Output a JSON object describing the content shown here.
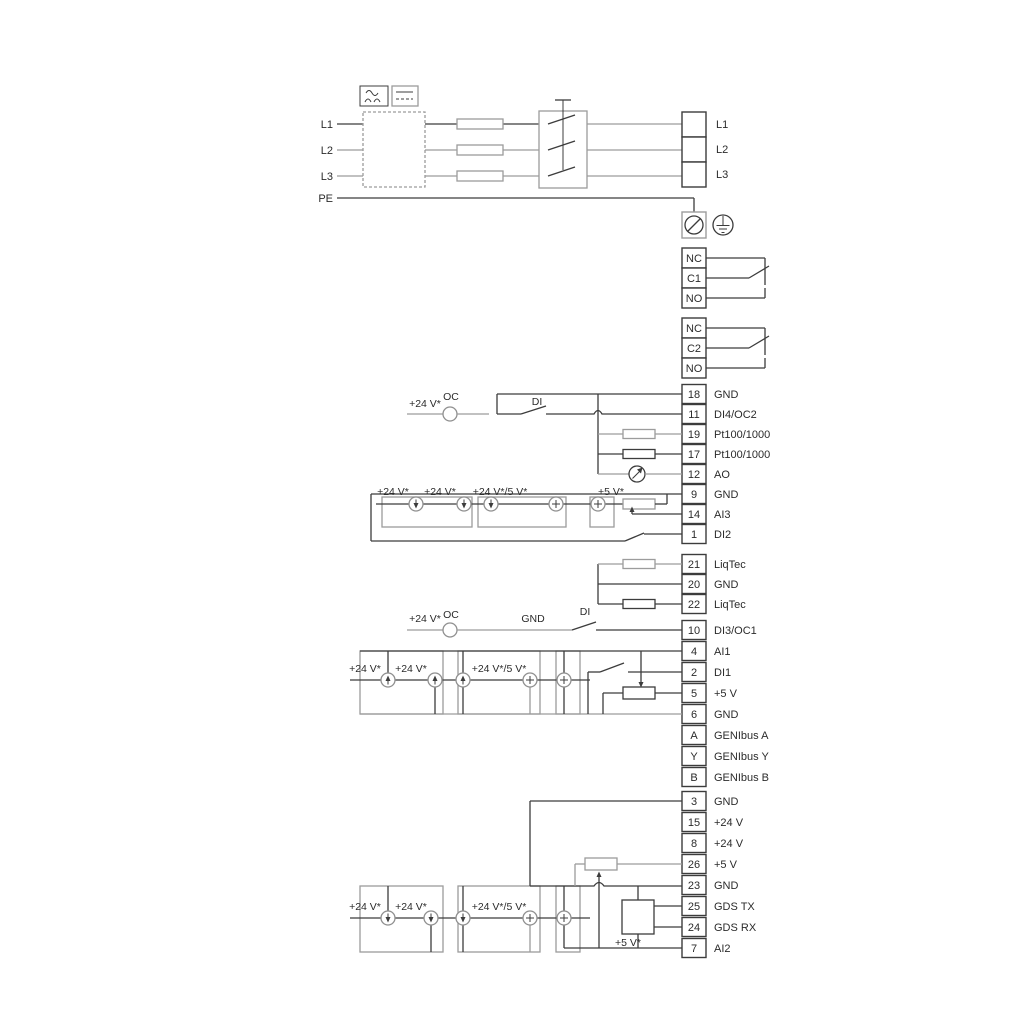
{
  "colors": {
    "dark": "#3c3c3c",
    "gray": "#9c9c9c",
    "background": "#ffffff"
  },
  "labels": {
    "v24": "+24 V*",
    "v24or5": "+24 V*/5 V*",
    "v5": "+5 V*",
    "oc": "OC",
    "di": "DI",
    "gnd": "GND"
  },
  "power": {
    "left": [
      "L1",
      "L2",
      "L3",
      "PE"
    ],
    "right": [
      "L1",
      "L2",
      "L3"
    ]
  },
  "relays": [
    {
      "rows": [
        "NC",
        "C1",
        "NO"
      ]
    },
    {
      "rows": [
        "NC",
        "C2",
        "NO"
      ]
    }
  ],
  "strip_a": [
    {
      "num": "18",
      "label": "GND"
    },
    {
      "num": "11",
      "label": "DI4/OC2"
    },
    {
      "num": "19",
      "label": "Pt100/1000"
    },
    {
      "num": "17",
      "label": "Pt100/1000"
    },
    {
      "num": "12",
      "label": "AO"
    },
    {
      "num": "9",
      "label": "GND"
    },
    {
      "num": "14",
      "label": "AI3"
    },
    {
      "num": "1",
      "label": "DI2"
    }
  ],
  "strip_liqtec": [
    {
      "num": "21",
      "label": "LiqTec"
    },
    {
      "num": "20",
      "label": "GND"
    },
    {
      "num": "22",
      "label": "LiqTec"
    }
  ],
  "strip_b": [
    {
      "num": "10",
      "label": "DI3/OC1"
    },
    {
      "num": "4",
      "label": "AI1"
    },
    {
      "num": "2",
      "label": "DI1"
    },
    {
      "num": "5",
      "label": "+5 V"
    },
    {
      "num": "6",
      "label": "GND"
    },
    {
      "num": "A",
      "label": "GENIbus A"
    },
    {
      "num": "Y",
      "label": "GENIbus Y"
    },
    {
      "num": "B",
      "label": "GENIbus B"
    }
  ],
  "strip_c": [
    {
      "num": "3",
      "label": "GND"
    },
    {
      "num": "15",
      "label": "+24 V"
    },
    {
      "num": "8",
      "label": "+24 V"
    },
    {
      "num": "26",
      "label": "+5 V"
    },
    {
      "num": "23",
      "label": "GND"
    },
    {
      "num": "25",
      "label": "GDS TX"
    },
    {
      "num": "24",
      "label": "GDS RX"
    },
    {
      "num": "7",
      "label": "AI2"
    }
  ]
}
